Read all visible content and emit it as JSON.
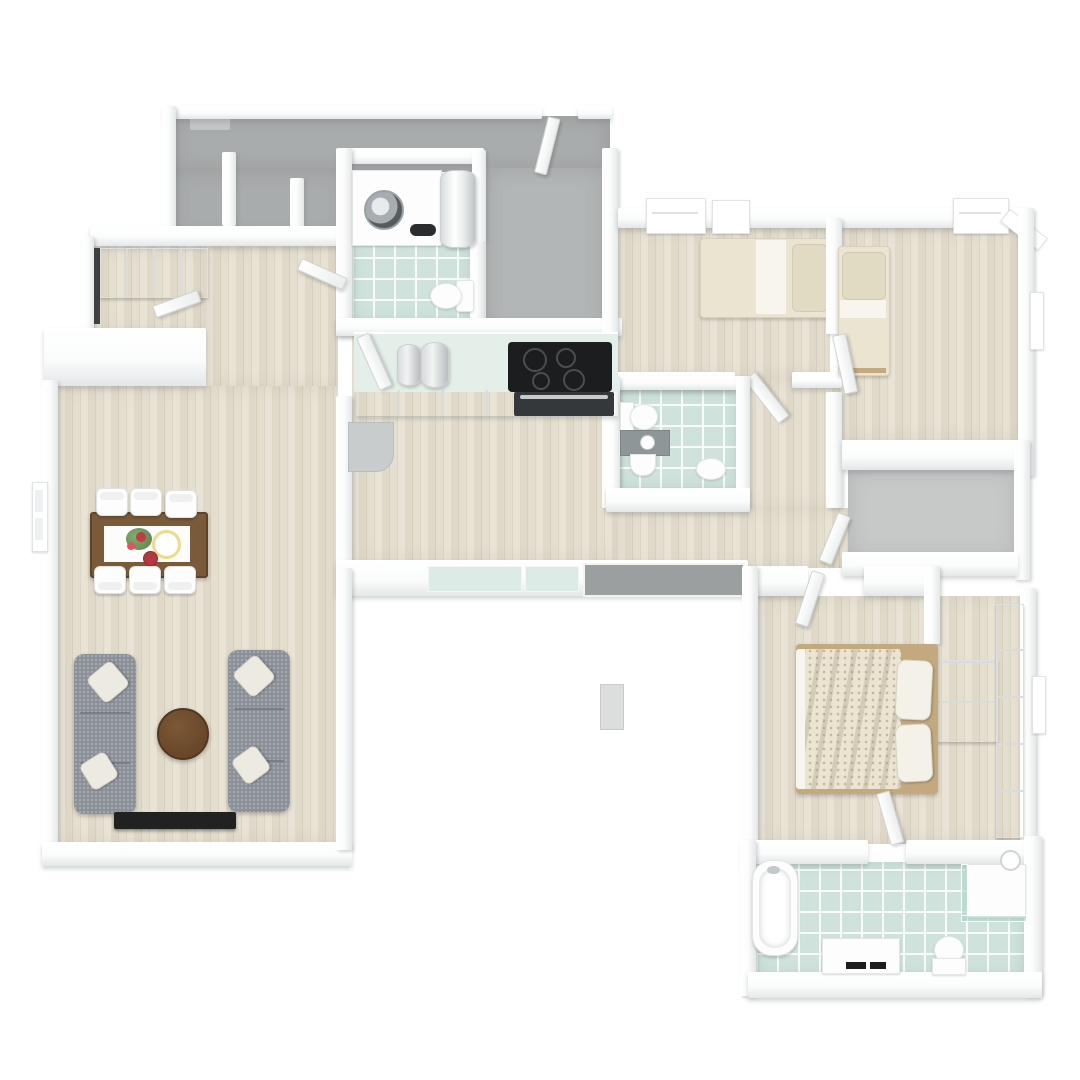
{
  "image": {
    "type": "3d-floor-plan-render",
    "view": "top-down 3D dollhouse view",
    "background": "#ffffff",
    "visible_text": ""
  },
  "palette": {
    "page-bg": "#ffffff",
    "wall": "#fbfcfc",
    "wall-shade": "#e4e7e8",
    "shadow": "rgba(120,126,130,0.32)",
    "gray-floor-dark": "#a9acac",
    "gray-floor-entry": "#b3b6b6",
    "gray-floor-storage": "#c7c9c9",
    "wood-light": "#e9e3d6",
    "wood-dark": "#d6cfbe",
    "tile": "#cfe2dc",
    "glass": "#dcebe6",
    "counter-top": "#e3efe8",
    "sofa": "#8b9098",
    "sofa-seam": "#6e737b",
    "pillow": "#edeae2",
    "table-wood": "#7a5a39",
    "coffee-table": "#6e4c2f",
    "tv-unit": "#212121",
    "bed-cream": "#eae4d1",
    "bed-sheet": "#f7f5ee",
    "bed-frame": "#c5a97e",
    "appliance-steel": "#b9bdbf",
    "cooktop": "#1b1d1e",
    "washstand-gray": "#8f9698",
    "dark-edge": "#3f4142"
  },
  "rooms": [
    {
      "name": "garage-utility-area",
      "floor": "gray-concrete"
    },
    {
      "name": "entry-hall",
      "floor": "gray-concrete"
    },
    {
      "name": "laundry-bathroom",
      "floor": "teal-tile",
      "fixtures": [
        "washing-machine-counter",
        "water-heater",
        "toilet"
      ]
    },
    {
      "name": "walk-in-closet",
      "floor": "wood",
      "fixtures": [
        "wardrobe-row"
      ]
    },
    {
      "name": "hallway",
      "floor": "wood"
    },
    {
      "name": "kitchen-family-room",
      "floor": "wood",
      "fixtures": [
        "kitchen-counter",
        "canisters",
        "cooktop",
        "oven",
        "side-cabinet"
      ]
    },
    {
      "name": "living-dining-room",
      "floor": "wood",
      "fixtures": [
        "dining-table",
        "dining-chairs-x6",
        "sofa-left",
        "sofa-right",
        "coffee-table",
        "tv-bench"
      ]
    },
    {
      "name": "bedroom-1",
      "floor": "wood",
      "fixtures": [
        "single-bed",
        "windows"
      ]
    },
    {
      "name": "bedroom-2",
      "floor": "wood",
      "fixtures": [
        "single-bed",
        "windows"
      ]
    },
    {
      "name": "small-bathroom",
      "floor": "teal-tile",
      "fixtures": [
        "toilet",
        "washstand",
        "pedestal-sink"
      ]
    },
    {
      "name": "storage-room",
      "floor": "gray-concrete"
    },
    {
      "name": "master-bedroom",
      "floor": "wood",
      "fixtures": [
        "double-bed",
        "wardrobe-block",
        "wardrobe-strip"
      ]
    },
    {
      "name": "master-bathroom",
      "floor": "teal-tile",
      "fixtures": [
        "bathtub",
        "shower-corner",
        "vanity-sink",
        "toilet"
      ]
    }
  ],
  "furniture_counts": {
    "sofas": 2,
    "dining_chairs": 6,
    "beds": 3,
    "toilets": 3,
    "bathtubs": 1,
    "showers": 1,
    "washing_machines": 1,
    "water_heaters": 1,
    "coffee_tables": 1,
    "dining_tables": 1
  }
}
